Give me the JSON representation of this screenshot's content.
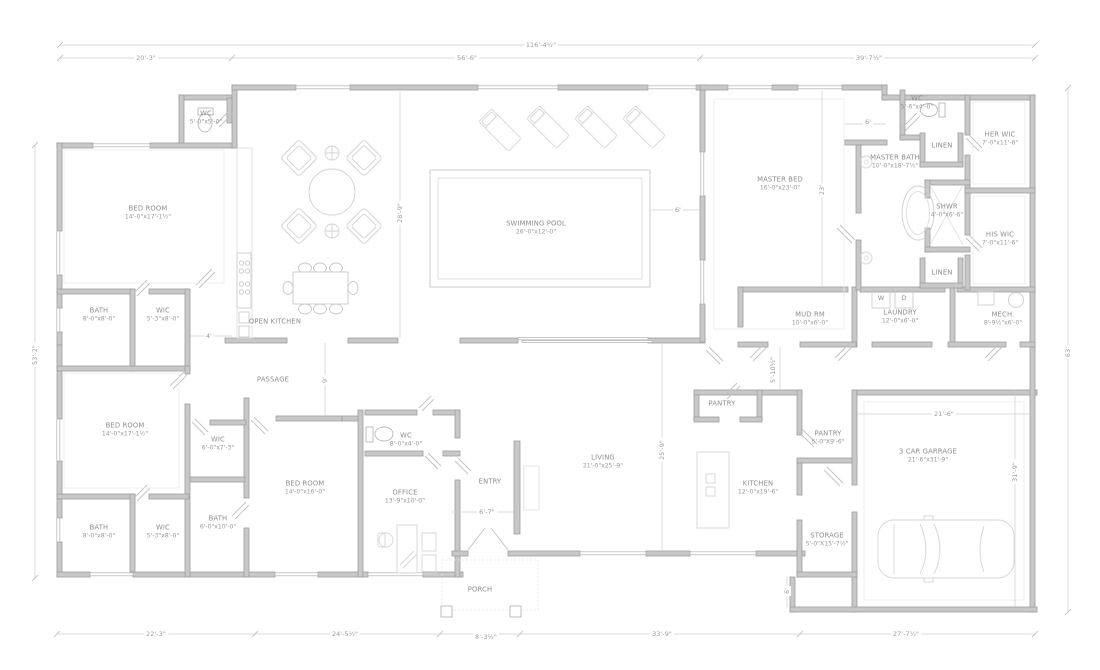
{
  "rooms": {
    "wc1": {
      "name": "WC",
      "size": "5'-0\"x5'-0\""
    },
    "bed1": {
      "name": "BED ROOM",
      "size": "14'-0\"x17'-1½\""
    },
    "bath1": {
      "name": "BATH",
      "size": "8'-0\"x8'-0\""
    },
    "wic1": {
      "name": "WIC",
      "size": "5'-3\"x8'-0\""
    },
    "open_kitchen": {
      "name": "OPEN KITCHEN"
    },
    "passage": {
      "name": "PASSAGE"
    },
    "bed2": {
      "name": "BED ROOM",
      "size": "14'-0\"x17'-1½\""
    },
    "wic2": {
      "name": "WIC",
      "size": "6'-0\"x7'-3\""
    },
    "bath2": {
      "name": "BATH",
      "size": "8'-0\"x8'-0\""
    },
    "wic3": {
      "name": "WIC",
      "size": "5'-3\"x8'-0\""
    },
    "bath3": {
      "name": "BATH",
      "size": "6'-0\"x10'-0\""
    },
    "bed3": {
      "name": "BED ROOM",
      "size": "14'-0\"x16'-0\""
    },
    "wc2": {
      "name": "WC",
      "size": "8'-0\"x4'-0\""
    },
    "office": {
      "name": "OFFICE",
      "size": "13'-9\"x10'-0\""
    },
    "entry": {
      "name": "ENTRY"
    },
    "porch": {
      "name": "PORCH"
    },
    "pool": {
      "name": "SWIMMING POOL",
      "size": "26'-0\"x12'-0\""
    },
    "living": {
      "name": "LIVING",
      "size": "21'-0\"x25'-9\""
    },
    "kitchen": {
      "name": "KITCHEN",
      "size": "12'-0\"x19'-6\""
    },
    "pantry_walk": {
      "name": "PANTRY"
    },
    "pantry": {
      "name": "PANTRY",
      "size": "5'-0\"X9'-6\""
    },
    "storage": {
      "name": "STORAGE",
      "size": "5'-0\"X15'-7½\""
    },
    "garage": {
      "name": "3 CAR GARRAGE",
      "size": "21'-6\"x31'-9\""
    },
    "master_bed": {
      "name": "MASTER BED",
      "size": "16'-0\"x23'-0\""
    },
    "master_bath": {
      "name": "MASTER BATH",
      "size": "10'-0\"x18'-7½\""
    },
    "wc3": {
      "name": "WC",
      "size": "5'-6\"x4'-0\""
    },
    "linen1": {
      "name": "LINEN"
    },
    "her_wic": {
      "name": "HER WIC",
      "size": "7'-0\"x11'-6\""
    },
    "shwr": {
      "name": "SHWR",
      "size": "4'-0\"x6'-6\""
    },
    "his_wic": {
      "name": "HIS WIC",
      "size": "7'-0\"x11'-6\""
    },
    "linen2": {
      "name": "LINEN"
    },
    "mud": {
      "name": "MUD RM",
      "size": "10'-0\"x6'-0\""
    },
    "laundry": {
      "name": "LAUNDRY",
      "size": "12'-0\"x6'-0\""
    },
    "mech": {
      "name": "MECH.",
      "size": "8'-9½\"x6'-0\""
    }
  },
  "appliances": {
    "washer": "W",
    "dryer": "D"
  },
  "dimensions": {
    "top_overall": "116'-4½\"",
    "top_left": "20'-3\"",
    "top_mid": "56'-6\"",
    "top_right": "39'-7½\"",
    "left_overall": "53'-2\"",
    "right_overall": "63'",
    "bottom_1": "22'-3\"",
    "bottom_2": "24'-5½\"",
    "bottom_3": "8'-3½\"",
    "bottom_4": "33'-9\"",
    "bottom_5": "27'-7½\"",
    "pool_height": "28'-9\"",
    "pool_right": "6'",
    "master_depth": "23'",
    "mbath_top": "6'",
    "open_kitchen_w": "4'",
    "passage_w": "9'",
    "mud_h": "5'-10½\"",
    "living_h": "25'-9\"",
    "entry_w": "6'-7\"",
    "garage_w": "21'-6\"",
    "garage_h": "31'-9\"",
    "storage_side": "6'"
  },
  "colors": {
    "wall_fill": "#c8c8c8",
    "wall_edge": "#9e9e9e",
    "text": "#8d8d8d",
    "dim_line": "#cccccc"
  }
}
